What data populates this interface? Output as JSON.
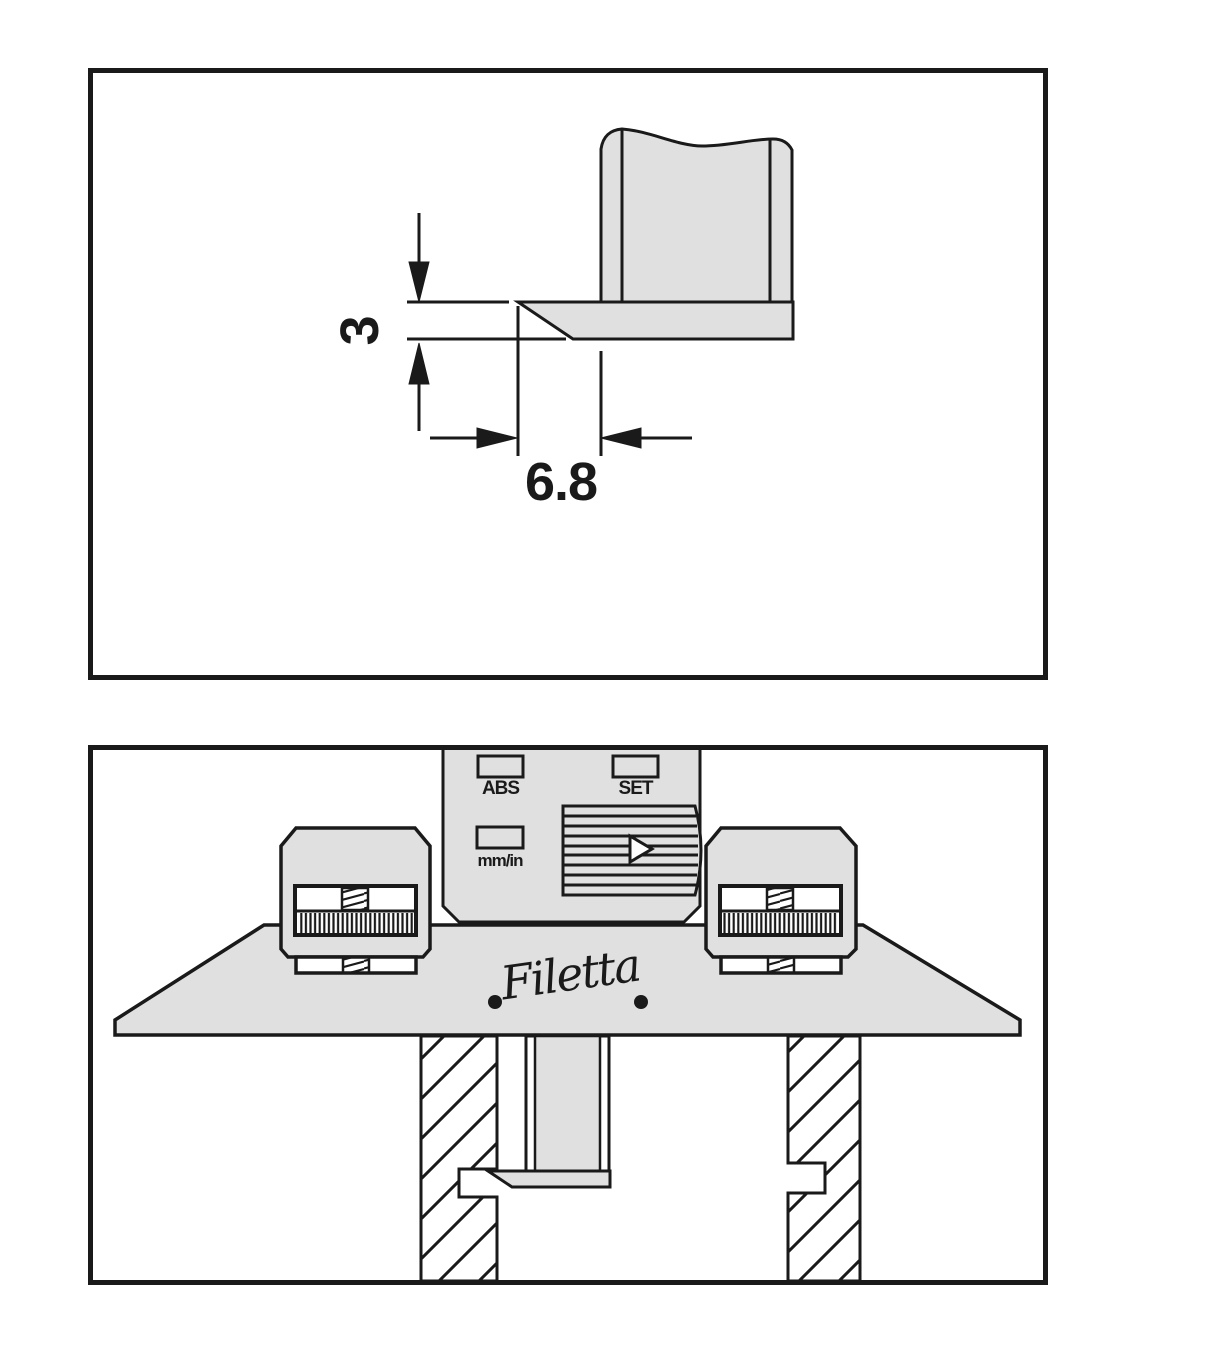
{
  "colors": {
    "fill_gray": "#e0e0e0",
    "line": "#1a1a1a",
    "background": "#ffffff"
  },
  "figure_top": {
    "description": "chamfer-detail-drawing",
    "dim_vertical": "3",
    "dim_horizontal": "6.8"
  },
  "figure_bottom": {
    "description": "depth-gauge-on-workpiece-illustration",
    "buttons": {
      "abs": "ABS",
      "set": "SET",
      "unit": "mm/in"
    },
    "brand": "Filetta"
  }
}
